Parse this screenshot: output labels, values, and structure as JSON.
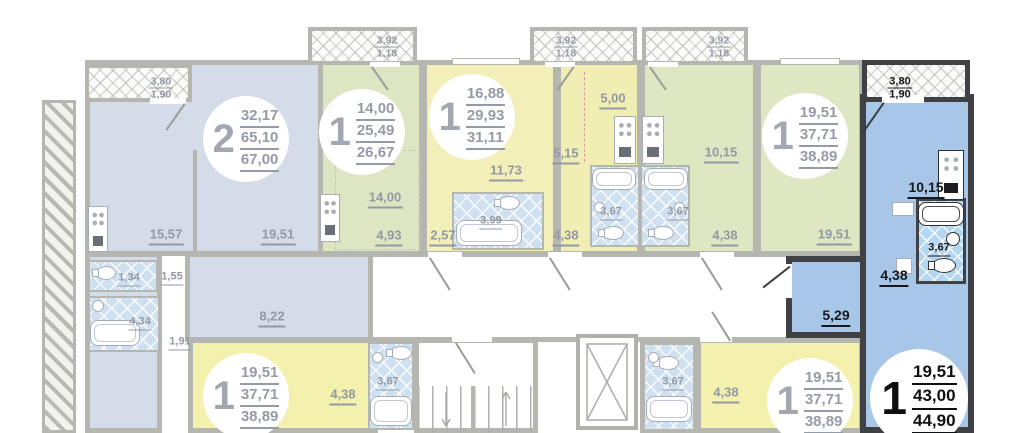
{
  "plan_type": "apartment-floor-plan",
  "colors": {
    "highlight_fill": "#a8c6e8",
    "highlight_wall": "#3f4145",
    "faded_wall": "#b6b6b1",
    "faded_text": "#9299a4",
    "dark_text": "#17181b",
    "bathroom_tile": "#cfe1f1",
    "bathroom_tile_highlight": "#b5d6f0",
    "unit_yellow": "#f2efb9",
    "unit_green": "#dee5c3",
    "unit_bluegray": "#d3dce8"
  },
  "units": [
    {
      "rooms": "2",
      "living": "32,17",
      "area": "65,10",
      "total": "67,00"
    },
    {
      "rooms": "1",
      "living": "14,00",
      "area": "25,49",
      "total": "26,67"
    },
    {
      "rooms": "1",
      "living": "16,88",
      "area": "29,93",
      "total": "31,11"
    },
    {
      "rooms": "1",
      "living": "19,51",
      "area": "37,71",
      "total": "38,89"
    },
    {
      "rooms": "1",
      "living": "19,51",
      "area": "37,71",
      "total": "38,89"
    },
    {
      "rooms": "1",
      "living": "19,51",
      "area": "37,71",
      "total": "38,89"
    },
    {
      "rooms": "1",
      "living": "19,51",
      "area": "43,00",
      "total": "44,90"
    }
  ],
  "balconies": [
    {
      "width": "3,80",
      "depth": "1,90"
    },
    {
      "width": "3,92",
      "depth": "1,18"
    },
    {
      "width": "3,92",
      "depth": "1,18"
    },
    {
      "width": "3,92",
      "depth": "1,18"
    },
    {
      "width": "3,80",
      "depth": "1,90"
    }
  ],
  "room_labels": [
    "15,57",
    "19,51",
    "1,34",
    "1,55",
    "4,34",
    "1,91",
    "8,22",
    "14,00",
    "4,93",
    "2,57",
    "3,99",
    "11,73",
    "5,00",
    "5,15",
    "3,67",
    "3,67",
    "4,38",
    "4,38",
    "10,15",
    "19,51",
    "4,38",
    "3,67",
    "3,67",
    "4,38"
  ],
  "highlight_labels": [
    "10,15",
    "3,67",
    "4,38",
    "5,29"
  ]
}
